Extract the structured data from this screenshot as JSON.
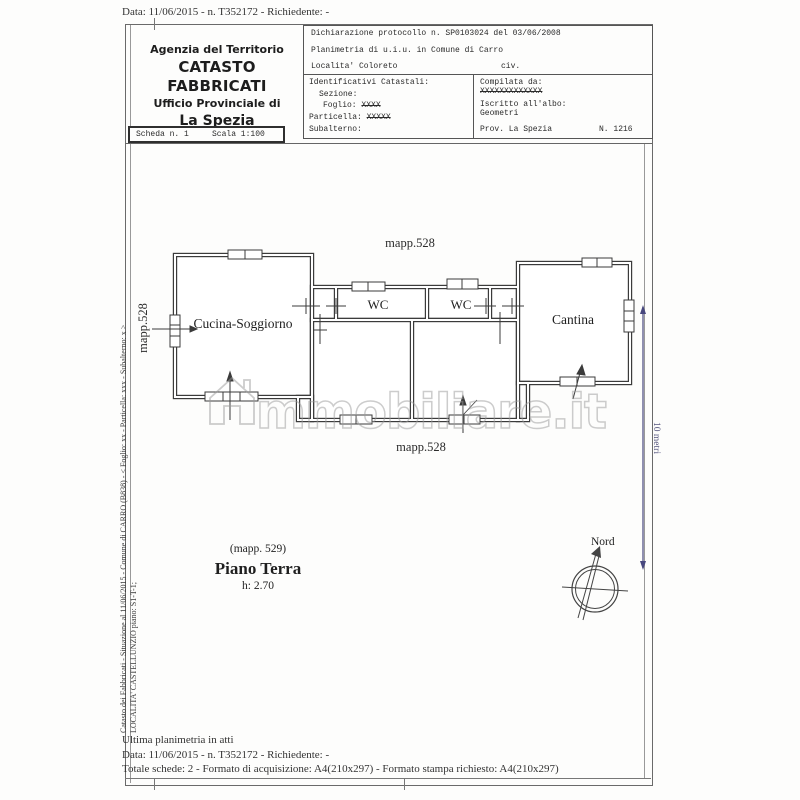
{
  "document": {
    "top_line": "Data: 11/06/2015 - n. T352172 - Richiedente: -",
    "header": {
      "agency_line1": "Agenzia del Territorio",
      "agency_line2": "CATASTO FABBRICATI",
      "agency_line3": "Ufficio Provinciale di",
      "agency_line4": "La Spezia",
      "scheda": "Scheda n. 1",
      "scala": "Scala 1:100",
      "dichiarazione": "Dichiarazione protocollo n. SP0103024 del 03/06/2008",
      "planimetria": "Planimetria di u.i.u. in Comune di Carro",
      "localita": "Localita' Coloreto",
      "civ": "civ.",
      "identificativi_title": "Identificativi Catastali:",
      "sezione_label": "Sezione:",
      "foglio_label": "Foglio:",
      "foglio_value": "XXXX",
      "particella_label": "Particella:",
      "particella_value": "XXXXX",
      "subalterno_label": "Subalterno:",
      "compilata_label": "Compilata da:",
      "compilata_value": "XXXXXXXXXXXXX",
      "albo_label": "Iscritto all'albo:",
      "albo_value": "Geometri",
      "prov": "Prov. La Spezia",
      "numero": "N. 1216"
    },
    "plan": {
      "mapp_top": "mapp.528",
      "mapp_bottom": "mapp.528",
      "mapp_left": "mapp.528",
      "rooms": [
        {
          "label": "Cucina-Soggiorno"
        },
        {
          "label": "WC"
        },
        {
          "label": "WC"
        },
        {
          "label": "Cantina"
        }
      ],
      "caption_mapp": "(mapp. 529)",
      "caption_title": "Piano Terra",
      "caption_height": "h: 2.70",
      "compass_label": "Nord",
      "scale_label": "10 metri"
    },
    "sidebar": {
      "line1": "Catasto dei Fabbricati - Situazione al 11/06/2015 - Comune di CARRO (B838) - < Foglio: xx - Particella: xxx - Subalterno: x >",
      "line2": "LOCALITA' CASTELLUNZIO piano: S1-T-1;"
    },
    "footer": {
      "line1": "Ultima planimetria in atti",
      "line2": "Data: 11/06/2015 - n. T352172 - Richiedente: -",
      "line3": "Totale schede: 2 - Formato di acquisizione: A4(210x297) - Formato stampa richiesto: A4(210x297)"
    },
    "watermark_text": "mmobiliare.it",
    "colors": {
      "wall": "#3b3b3b",
      "dimension_line": "#47477e",
      "watermark": "#9b9b9b"
    }
  }
}
